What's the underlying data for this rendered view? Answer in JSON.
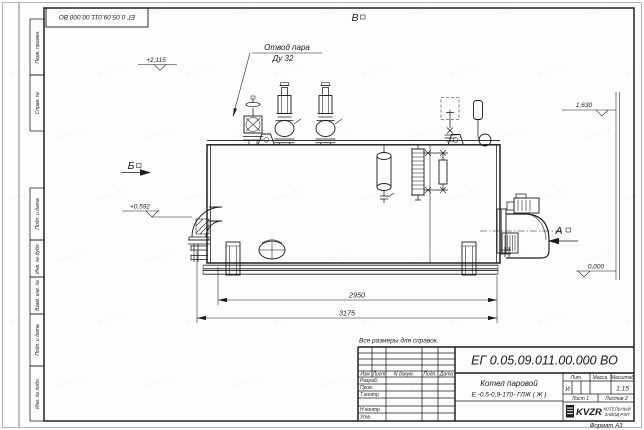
{
  "watermark": {
    "text": "kvzr.ru"
  },
  "frame": {
    "top_doc_number": "ЕГ 0.05.09.011.00.000  ВО",
    "format_label": "Формат А3",
    "side_labels": [
      "Перв. примен.",
      "Справ. №",
      "Подп. и дата",
      "Инв. № дубл.",
      "Взам. инв. №",
      "Подп. и дата",
      "Инв. № подл."
    ]
  },
  "title_block": {
    "doc_number": "ЕГ 0.05.09.011.00.000  ВО",
    "product_name_line1": "Котел паровой",
    "product_name_line2": "Е -0,5-0,9-170- ГЛЖ ( Ж )",
    "note": "Все размеры для справок.",
    "headers": {
      "lit": "Лит.",
      "mass": "Масса",
      "scale": "Масштаб"
    },
    "lit_value": "И",
    "scale_value": "1:15",
    "sheet_text": "Лист 1",
    "sheets_text": "Листов 2",
    "sig_headers": [
      "Изм",
      "Лист",
      "N докум.",
      "Подп.",
      "Дата"
    ],
    "sig_rows": [
      "Разраб.",
      "Пров.",
      "Т.контр",
      "",
      "Н.контр",
      "Утв."
    ],
    "company": {
      "logo": "KVZR",
      "name_line1": "КОТЕЛЬНЫЙ",
      "name_line2": "ЗАВОД РЭП"
    }
  },
  "drawing": {
    "steam_outlet": {
      "line1": "Отвод пара",
      "line2": "Ду 32"
    },
    "views": {
      "a": "А",
      "b": "Б",
      "v": "В"
    },
    "elevations": {
      "top": "+2,115",
      "left_mid": "+0,592",
      "right_top": "1,630",
      "zero": "0,000"
    },
    "dimensions": {
      "inner_length": "2950",
      "overall_length": "3175"
    }
  }
}
